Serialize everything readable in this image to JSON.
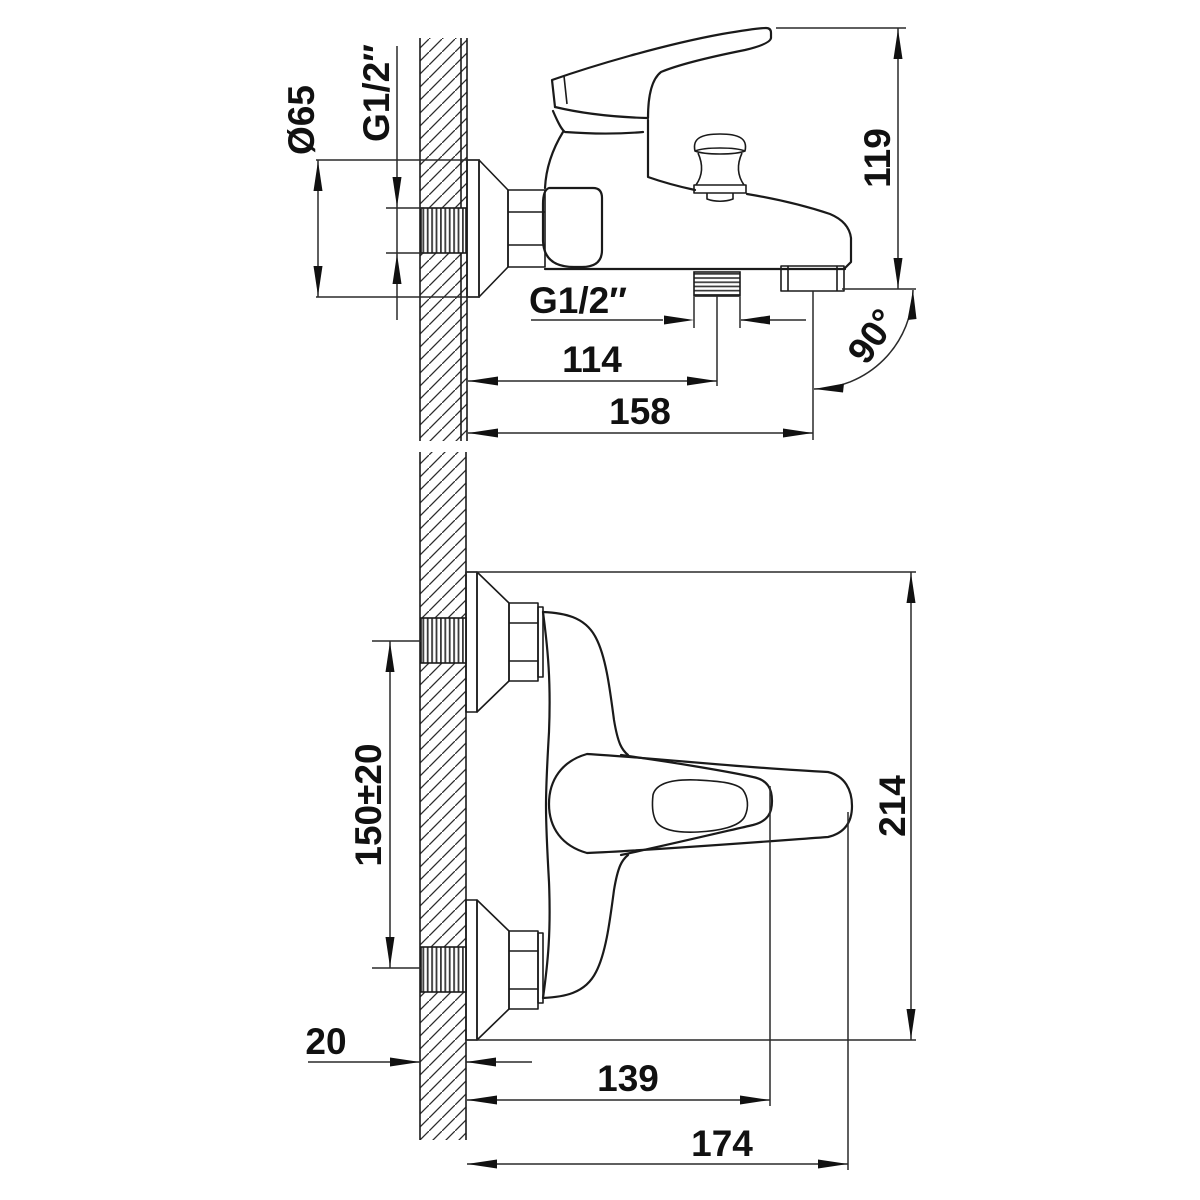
{
  "drawing": {
    "background": "#ffffff",
    "line_color": "#1a1a1a",
    "dimensions": {
      "escutcheon_diameter": "Ø65",
      "wall_thread_size": "G1/2″",
      "body_height": "119",
      "outlet_thread_size": "G1/2″",
      "outlet_offset": "114",
      "spout_reach": "158",
      "outlet_angle": "90°",
      "inlet_spacing": "150±20",
      "overall_height": "214",
      "wall_thickness": "20",
      "handle_projection": "139",
      "overall_projection": "174"
    }
  }
}
